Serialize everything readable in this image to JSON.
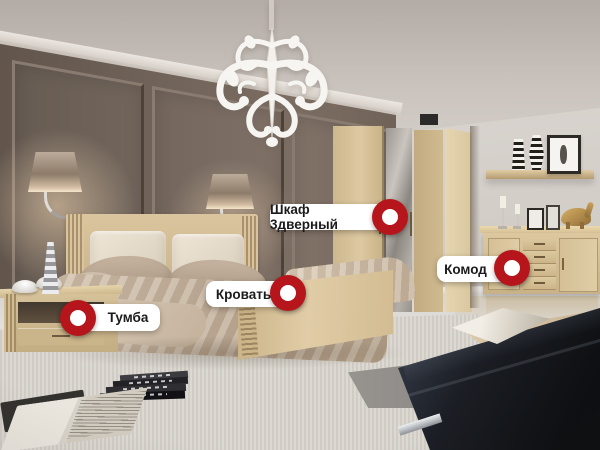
{
  "hotspots": [
    {
      "id": "wardrobe-3-door",
      "label": "Шкаф 3дверный",
      "marker_side": "right"
    },
    {
      "id": "bed",
      "label": "Кровать",
      "marker_side": "right"
    },
    {
      "id": "commode",
      "label": "Комод",
      "marker_side": "right"
    },
    {
      "id": "nightstand",
      "label": "Тумба",
      "marker_side": "left"
    }
  ],
  "colors": {
    "marker_red": "#b5151b",
    "marker_dot": "#ffffff",
    "label_background": "#ffffff",
    "label_text": "#1b1b1d",
    "wall_dark": "#6e6157",
    "wall_light": "#d5d0ca",
    "wood_oak": "#d3bd94"
  },
  "scene": {
    "objects": [
      "chandelier",
      "wall-sconce-left",
      "wall-sconce-right",
      "bed",
      "headboard",
      "pillows",
      "duvet",
      "wardrobe-with-mirror",
      "nightstand",
      "commode",
      "wall-shelf",
      "striped-vases",
      "picture-frames",
      "candlesticks",
      "elephant-figurine",
      "black-bench",
      "throw-blanket",
      "book-stack",
      "open-book",
      "wall-panels",
      "carpet"
    ]
  }
}
